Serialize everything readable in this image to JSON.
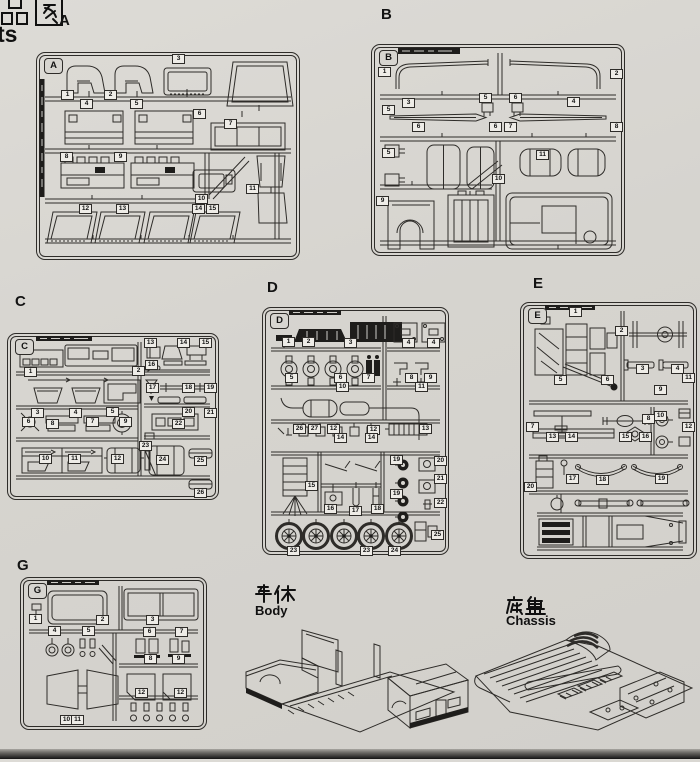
{
  "page": {
    "header": {
      "cn_partial": "品图",
      "en_partial": "ts"
    }
  },
  "captions": {
    "body_cn": "车体",
    "body_en": "Body",
    "chassis_cn": "底盘",
    "chassis_en": "Chassis"
  },
  "colors": {
    "paper": "#d7d5d0",
    "ink": "#2e2c29",
    "tag_fill": "#eeece7"
  },
  "sprues": [
    {
      "id": "A",
      "letter": "A",
      "parts": [
        {
          "n": "1",
          "x": 24,
          "y": 37
        },
        {
          "n": "2",
          "x": 67,
          "y": 37
        },
        {
          "n": "3",
          "x": 135,
          "y": 1
        },
        {
          "n": "4",
          "x": 43,
          "y": 46
        },
        {
          "n": "5",
          "x": 93,
          "y": 46
        },
        {
          "n": "6",
          "x": 156,
          "y": 56
        },
        {
          "n": "7",
          "x": 187,
          "y": 66
        },
        {
          "n": "8",
          "x": 23,
          "y": 99
        },
        {
          "n": "9",
          "x": 77,
          "y": 99
        },
        {
          "n": "10",
          "x": 158,
          "y": 141
        },
        {
          "n": "11",
          "x": 209,
          "y": 131
        },
        {
          "n": "12",
          "x": 42,
          "y": 151
        },
        {
          "n": "13",
          "x": 79,
          "y": 151
        },
        {
          "n": "14",
          "x": 155,
          "y": 151
        },
        {
          "n": "15",
          "x": 169,
          "y": 151
        }
      ]
    },
    {
      "id": "B",
      "letter": "B",
      "parts": [
        {
          "n": "1",
          "x": 6,
          "y": 22
        },
        {
          "n": "2",
          "x": 238,
          "y": 24
        },
        {
          "n": "3",
          "x": 30,
          "y": 53
        },
        {
          "n": "4",
          "x": 195,
          "y": 52
        },
        {
          "n": "5",
          "x": 107,
          "y": 48
        },
        {
          "n": "6",
          "x": 137,
          "y": 48
        },
        {
          "n": "5",
          "x": 10,
          "y": 60
        },
        {
          "n": "5",
          "x": 10,
          "y": 103
        },
        {
          "n": "6",
          "x": 40,
          "y": 77
        },
        {
          "n": "6",
          "x": 117,
          "y": 77
        },
        {
          "n": "7",
          "x": 132,
          "y": 77
        },
        {
          "n": "8",
          "x": 238,
          "y": 77
        },
        {
          "n": "9",
          "x": 4,
          "y": 151
        },
        {
          "n": "10",
          "x": 120,
          "y": 129
        },
        {
          "n": "11",
          "x": 164,
          "y": 105
        }
      ]
    },
    {
      "id": "C",
      "letter": "C",
      "parts": [
        {
          "n": "1",
          "x": 16,
          "y": 33
        },
        {
          "n": "2",
          "x": 124,
          "y": 32
        },
        {
          "n": "3",
          "x": 23,
          "y": 74
        },
        {
          "n": "4",
          "x": 61,
          "y": 74
        },
        {
          "n": "5",
          "x": 98,
          "y": 73
        },
        {
          "n": "6",
          "x": 14,
          "y": 83
        },
        {
          "n": "7",
          "x": 78,
          "y": 83
        },
        {
          "n": "8",
          "x": 38,
          "y": 85
        },
        {
          "n": "9",
          "x": 111,
          "y": 83
        },
        {
          "n": "10",
          "x": 31,
          "y": 120
        },
        {
          "n": "11",
          "x": 60,
          "y": 120
        },
        {
          "n": "12",
          "x": 103,
          "y": 120
        },
        {
          "n": "13",
          "x": 136,
          "y": 4
        },
        {
          "n": "14",
          "x": 169,
          "y": 4
        },
        {
          "n": "15",
          "x": 191,
          "y": 4
        },
        {
          "n": "16",
          "x": 137,
          "y": 26
        },
        {
          "n": "17",
          "x": 138,
          "y": 49
        },
        {
          "n": "18",
          "x": 174,
          "y": 49
        },
        {
          "n": "19",
          "x": 196,
          "y": 49
        },
        {
          "n": "20",
          "x": 174,
          "y": 73
        },
        {
          "n": "21",
          "x": 196,
          "y": 74
        },
        {
          "n": "22",
          "x": 164,
          "y": 85
        },
        {
          "n": "23",
          "x": 131,
          "y": 107
        },
        {
          "n": "24",
          "x": 148,
          "y": 121
        },
        {
          "n": "25",
          "x": 186,
          "y": 122
        },
        {
          "n": "26",
          "x": 186,
          "y": 154
        }
      ]
    },
    {
      "id": "D",
      "letter": "D",
      "parts": [
        {
          "n": "1",
          "x": 19,
          "y": 29
        },
        {
          "n": "2",
          "x": 39,
          "y": 29
        },
        {
          "n": "3",
          "x": 81,
          "y": 30
        },
        {
          "n": "4",
          "x": 139,
          "y": 30
        },
        {
          "n": "4",
          "x": 164,
          "y": 30
        },
        {
          "n": "5",
          "x": 22,
          "y": 65
        },
        {
          "n": "6",
          "x": 71,
          "y": 65
        },
        {
          "n": "7",
          "x": 99,
          "y": 65
        },
        {
          "n": "8",
          "x": 142,
          "y": 65
        },
        {
          "n": "9",
          "x": 161,
          "y": 65
        },
        {
          "n": "10",
          "x": 73,
          "y": 74
        },
        {
          "n": "11",
          "x": 152,
          "y": 74
        },
        {
          "n": "26",
          "x": 30,
          "y": 116
        },
        {
          "n": "27",
          "x": 45,
          "y": 116
        },
        {
          "n": "12",
          "x": 64,
          "y": 116
        },
        {
          "n": "12",
          "x": 104,
          "y": 117
        },
        {
          "n": "13",
          "x": 156,
          "y": 116
        },
        {
          "n": "14",
          "x": 71,
          "y": 125
        },
        {
          "n": "14",
          "x": 102,
          "y": 125
        },
        {
          "n": "15",
          "x": 42,
          "y": 173
        },
        {
          "n": "16",
          "x": 61,
          "y": 196
        },
        {
          "n": "17",
          "x": 86,
          "y": 198
        },
        {
          "n": "18",
          "x": 108,
          "y": 196
        },
        {
          "n": "19",
          "x": 127,
          "y": 147
        },
        {
          "n": "19",
          "x": 127,
          "y": 181
        },
        {
          "n": "20",
          "x": 171,
          "y": 148
        },
        {
          "n": "21",
          "x": 171,
          "y": 166
        },
        {
          "n": "22",
          "x": 171,
          "y": 190
        },
        {
          "n": "23",
          "x": 24,
          "y": 238
        },
        {
          "n": "23",
          "x": 97,
          "y": 238
        },
        {
          "n": "24",
          "x": 125,
          "y": 238
        },
        {
          "n": "25",
          "x": 168,
          "y": 222
        }
      ]
    },
    {
      "id": "E",
      "letter": "E",
      "parts": [
        {
          "n": "1",
          "x": 48,
          "y": 4
        },
        {
          "n": "2",
          "x": 94,
          "y": 23
        },
        {
          "n": "3",
          "x": 115,
          "y": 61
        },
        {
          "n": "4",
          "x": 150,
          "y": 61
        },
        {
          "n": "5",
          "x": 33,
          "y": 72
        },
        {
          "n": "6",
          "x": 80,
          "y": 72
        },
        {
          "n": "7",
          "x": 5,
          "y": 119
        },
        {
          "n": "8",
          "x": 121,
          "y": 111
        },
        {
          "n": "9",
          "x": 133,
          "y": 82
        },
        {
          "n": "10",
          "x": 133,
          "y": 108
        },
        {
          "n": "11",
          "x": 161,
          "y": 70
        },
        {
          "n": "12",
          "x": 161,
          "y": 119
        },
        {
          "n": "13",
          "x": 25,
          "y": 129
        },
        {
          "n": "14",
          "x": 44,
          "y": 129
        },
        {
          "n": "15",
          "x": 98,
          "y": 129
        },
        {
          "n": "16",
          "x": 118,
          "y": 129
        },
        {
          "n": "17",
          "x": 45,
          "y": 171
        },
        {
          "n": "18",
          "x": 75,
          "y": 172
        },
        {
          "n": "19",
          "x": 134,
          "y": 171
        },
        {
          "n": "20",
          "x": 3,
          "y": 179
        }
      ]
    },
    {
      "id": "G",
      "letter": "G",
      "parts": [
        {
          "n": "1",
          "x": 8,
          "y": 36
        },
        {
          "n": "2",
          "x": 75,
          "y": 37
        },
        {
          "n": "3",
          "x": 125,
          "y": 37
        },
        {
          "n": "4",
          "x": 27,
          "y": 48
        },
        {
          "n": "5",
          "x": 61,
          "y": 48
        },
        {
          "n": "6",
          "x": 122,
          "y": 49
        },
        {
          "n": "7",
          "x": 154,
          "y": 49
        },
        {
          "n": "8",
          "x": 123,
          "y": 76
        },
        {
          "n": "9",
          "x": 151,
          "y": 76
        },
        {
          "n": "10",
          "x": 39,
          "y": 137
        },
        {
          "n": "11",
          "x": 50,
          "y": 137
        },
        {
          "n": "12",
          "x": 114,
          "y": 110
        },
        {
          "n": "12",
          "x": 153,
          "y": 110
        }
      ]
    }
  ]
}
